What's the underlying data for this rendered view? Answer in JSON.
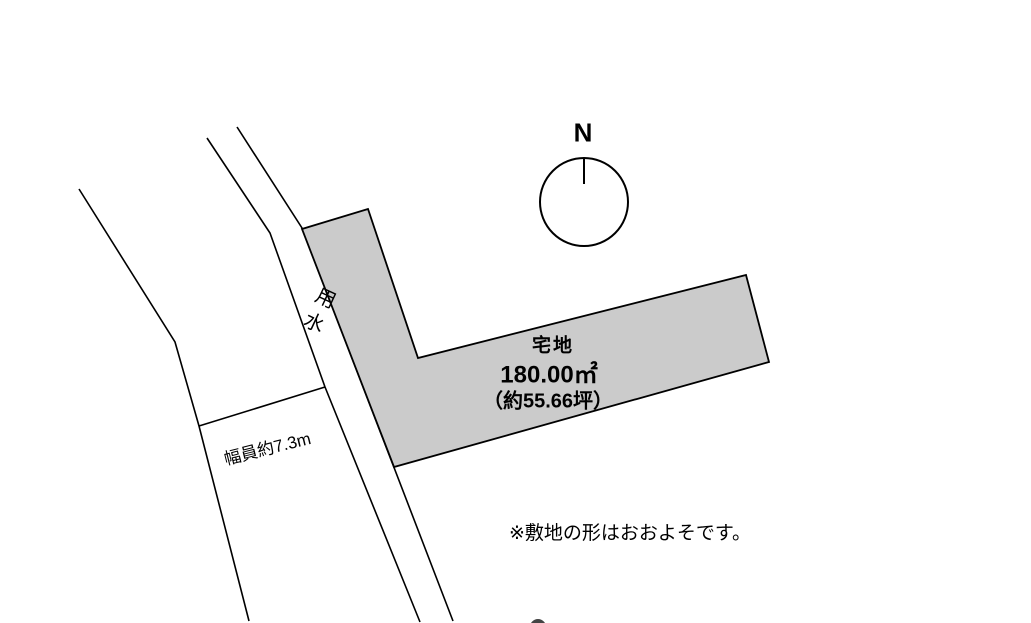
{
  "compass": {
    "north_label": "N"
  },
  "plot": {
    "name": "宅地",
    "area_sqm": "180.00㎡",
    "area_tsubo": "（約55.66坪）",
    "fill_color": "#cbcbcb",
    "line_color": "#000000"
  },
  "waterway": {
    "label": "用水"
  },
  "road": {
    "width_label": "幅員約7.3m"
  },
  "note": {
    "text": "※敷地の形はおおよそです。"
  }
}
